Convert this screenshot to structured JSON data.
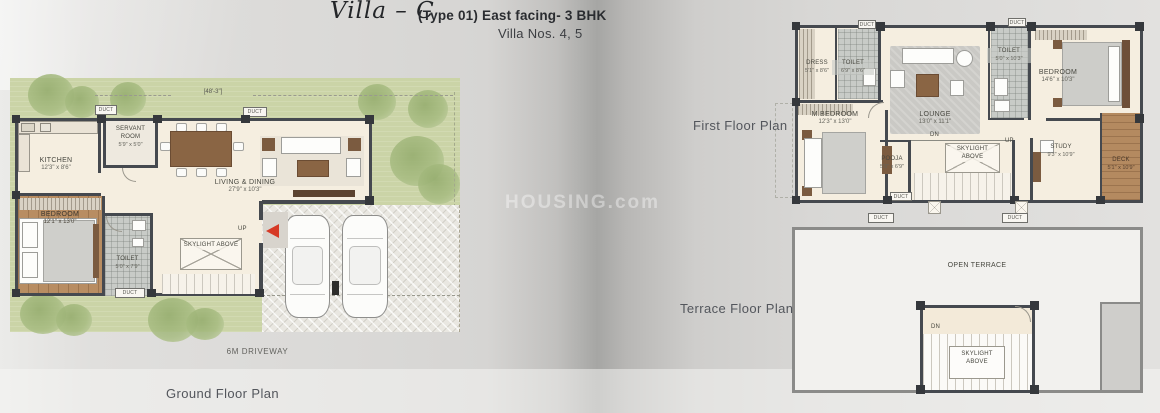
{
  "header": {
    "villa_name": "Villa – C",
    "type_line": "(Type 01) East facing- 3 BHK",
    "villa_nos": "Villa Nos. 4, 5"
  },
  "watermark": "HOUSING.com",
  "labels": {
    "ground_plan": "Ground Floor Plan",
    "first_plan": "First Floor Plan",
    "terrace_plan": "Terrace Floor Plan",
    "driveway": "6M DRIVEWAY",
    "plot_dim": "[48'-3\"]",
    "open_terrace": "OPEN TERRACE"
  },
  "annotations": {
    "up": "UP",
    "dn": "DN",
    "duct": "DUCT",
    "skylight": "SKYLIGHT ABOVE"
  },
  "rooms": {
    "ground": {
      "kitchen": {
        "name": "KITCHEN",
        "dim": "12'3\" x 8'6\""
      },
      "servant": {
        "name": "SERVANT ROOM",
        "dim": "5'9\" x 5'0\""
      },
      "living": {
        "name": "LIVING & DINING",
        "dim": "27'9\" x 10'3\""
      },
      "bedroom": {
        "name": "BEDROOM",
        "dim": "12'1\" x 13'0\""
      },
      "toilet": {
        "name": "TOILET",
        "dim": "5'0\" x 7'9\""
      }
    },
    "first": {
      "dress": {
        "name": "DRESS",
        "dim": "5'1\" x 8'6\""
      },
      "toilet1": {
        "name": "TOILET",
        "dim": "6'9\" x 8'6\""
      },
      "mbedroom": {
        "name": "M.BEDROOM",
        "dim": "12'3\" x 13'0\""
      },
      "lounge": {
        "name": "LOUNGE",
        "dim": "13'0\" x 11'1\""
      },
      "toilet2": {
        "name": "TOILET",
        "dim": "5'0\" x 10'3\""
      },
      "bedroom": {
        "name": "BEDROOM",
        "dim": "14'6\" x 10'3\""
      },
      "pooja": {
        "name": "POOJA",
        "dim": "5'0\" x 6'9\""
      },
      "study": {
        "name": "STUDY",
        "dim": "9'3\" x 10'9\""
      },
      "deck": {
        "name": "DECK",
        "dim": "5'1\" x 10'9\""
      }
    }
  }
}
